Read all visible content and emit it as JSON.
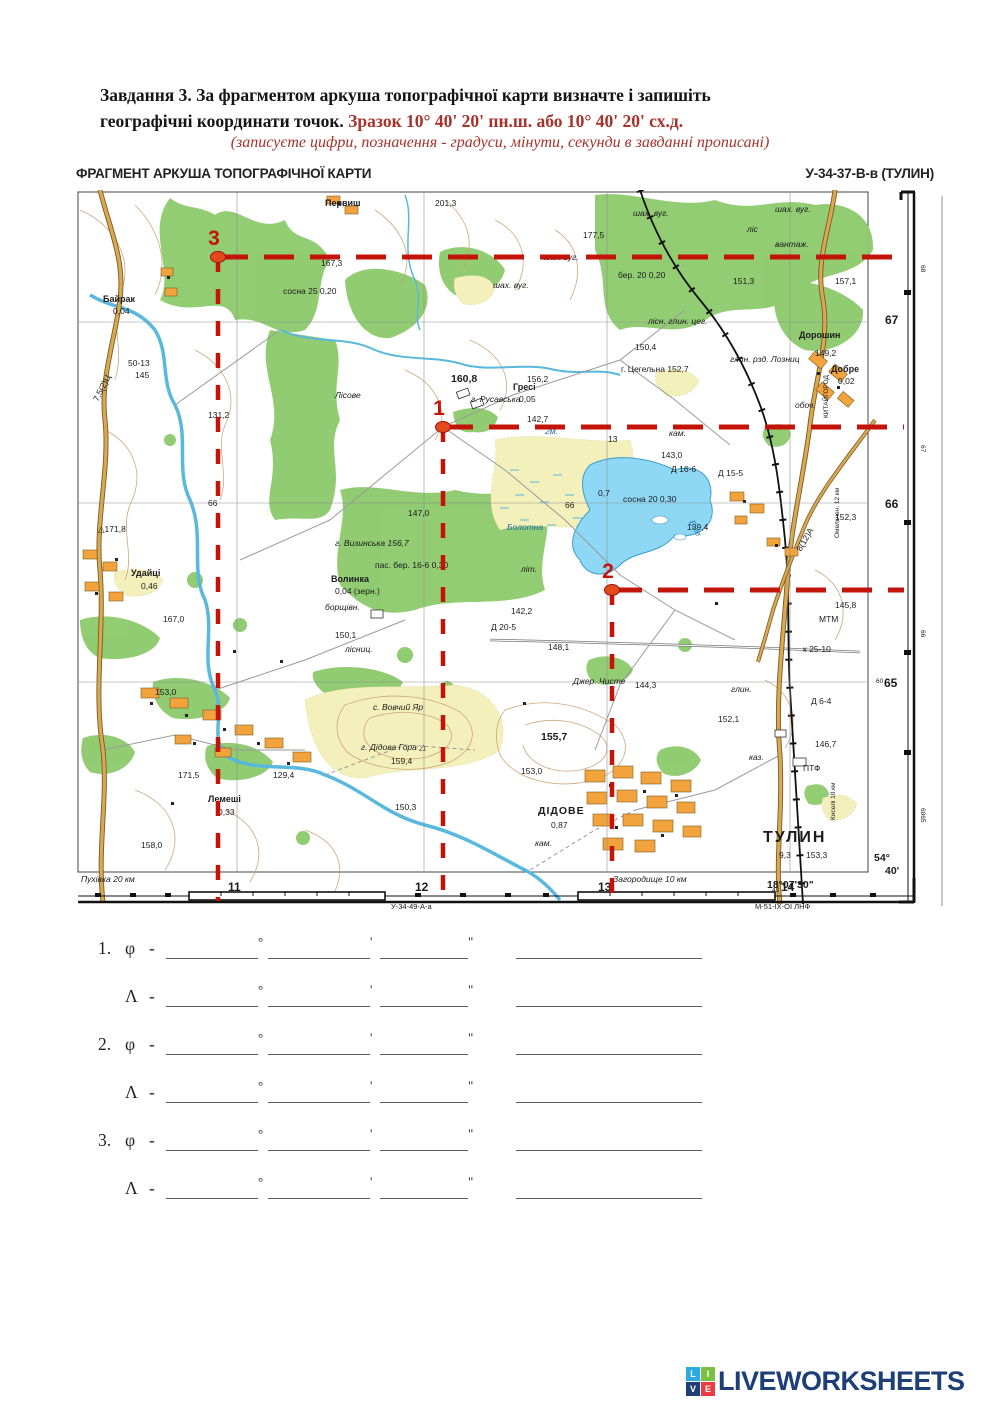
{
  "header": {
    "task_line1": "Завдання 3. За фрагментом аркуша топографічної карти визначте і запишіть",
    "task_line2": "географічні координати точок.",
    "sample": "Зразок 10° 40' 20' пн.ш.  або 10° 40' 20' сх.д.",
    "note": "(записуєте цифри, позначення - градуси, мінути, секунди в завданні прописані)",
    "accent_color": "#a8322a"
  },
  "map": {
    "title_left": "ФРАГМЕНТ АРКУША ТОПОГРАФІЧНОЇ КАРТИ",
    "title_right": "У-34-37-В-в (ТУЛИН)",
    "accent": "#c41309",
    "grid": {
      "v": [
        162,
        349,
        532,
        715
      ],
      "h": [
        132,
        313,
        492
      ]
    },
    "points": [
      {
        "n": "3",
        "x": 143,
        "y": 67
      },
      {
        "n": "1",
        "x": 368,
        "y": 237
      },
      {
        "n": "2",
        "x": 537,
        "y": 400
      }
    ],
    "labels": [
      {
        "x": 360,
        "y": 16,
        "t": "201,3"
      },
      {
        "x": 250,
        "y": 16,
        "t": "Первиш",
        "cls": "vil"
      },
      {
        "x": 508,
        "y": 48,
        "t": "177,5"
      },
      {
        "x": 558,
        "y": 26,
        "t": "шах. вуг.",
        "cls": "it"
      },
      {
        "x": 700,
        "y": 22,
        "t": "шах. вуг.",
        "cls": "it"
      },
      {
        "x": 672,
        "y": 42,
        "t": "ліс",
        "cls": "it"
      },
      {
        "x": 418,
        "y": 98,
        "t": "шах. вуг.",
        "cls": "it"
      },
      {
        "x": 468,
        "y": 70,
        "t": "шах. вуг.",
        "cls": "it"
      },
      {
        "x": 700,
        "y": 57,
        "t": "вантаж.",
        "cls": "it"
      },
      {
        "x": 246,
        "y": 76,
        "t": "167,3"
      },
      {
        "x": 543,
        "y": 88,
        "t": "бер. 20 0,20"
      },
      {
        "x": 658,
        "y": 94,
        "t": "151,3"
      },
      {
        "x": 760,
        "y": 94,
        "t": "157,1"
      },
      {
        "x": 28,
        "y": 112,
        "t": "Байрак",
        "cls": "vil"
      },
      {
        "x": 38,
        "y": 124,
        "t": "0,04"
      },
      {
        "x": 208,
        "y": 104,
        "t": "сосна 25 0,20"
      },
      {
        "x": 260,
        "y": 208,
        "t": "Лісове",
        "cls": "it"
      },
      {
        "x": 573,
        "y": 134,
        "t": "лісн. глин. цег.",
        "cls": "it"
      },
      {
        "x": 560,
        "y": 160,
        "t": "150,4"
      },
      {
        "x": 655,
        "y": 172,
        "t": "глин. рзд. Лозниц",
        "cls": "it"
      },
      {
        "x": 724,
        "y": 148,
        "t": "Дорошин",
        "cls": "vil"
      },
      {
        "x": 740,
        "y": 166,
        "t": "149,2"
      },
      {
        "x": 756,
        "y": 182,
        "t": "Добре",
        "cls": "vil"
      },
      {
        "x": 763,
        "y": 194,
        "t": "0,02"
      },
      {
        "x": 546,
        "y": 182,
        "t": "г. Цегельна 152,7"
      },
      {
        "x": 53,
        "y": 176,
        "t": "50-13"
      },
      {
        "x": 60,
        "y": 188,
        "t": "145"
      },
      {
        "x": 133,
        "y": 228,
        "t": "131,2"
      },
      {
        "x": 548,
        "y": 312,
        "t": "сосна 20 0,30"
      },
      {
        "x": 376,
        "y": 192,
        "t": "160,8",
        "cls": "md2"
      },
      {
        "x": 452,
        "y": 192,
        "t": "156,2"
      },
      {
        "x": 396,
        "y": 212,
        "t": "г. Русавська",
        "cls": "it"
      },
      {
        "x": 438,
        "y": 200,
        "t": "Гресі",
        "cls": "vil"
      },
      {
        "x": 444,
        "y": 212,
        "t": "0,05"
      },
      {
        "x": 452,
        "y": 232,
        "t": "142,7"
      },
      {
        "x": 470,
        "y": 244,
        "t": "2м.",
        "cls": "itb"
      },
      {
        "x": 594,
        "y": 246,
        "t": "кам.",
        "cls": "it"
      },
      {
        "x": 586,
        "y": 268,
        "t": "143,0"
      },
      {
        "x": 596,
        "y": 282,
        "t": "Д 16-6"
      },
      {
        "x": 643,
        "y": 286,
        "t": "Д 15-5"
      },
      {
        "x": 720,
        "y": 218,
        "t": "обоч.",
        "cls": "it"
      },
      {
        "x": 523,
        "y": 306,
        "t": "0,7"
      },
      {
        "x": 533,
        "y": 252,
        "t": "13"
      },
      {
        "x": 490,
        "y": 318,
        "t": "66"
      },
      {
        "x": 133,
        "y": 316,
        "t": "66"
      },
      {
        "x": 612,
        "y": 340,
        "t": "139,4"
      },
      {
        "x": 432,
        "y": 340,
        "t": "Болотна",
        "cls": "itb"
      },
      {
        "x": 614,
        "y": 332,
        "t": "Біле",
        "cls": "itb",
        "r": 62
      },
      {
        "x": 760,
        "y": 330,
        "t": "152,3"
      },
      {
        "x": 23,
        "y": 342,
        "t": "△171,8"
      },
      {
        "x": 56,
        "y": 386,
        "t": "Удайці",
        "cls": "vil"
      },
      {
        "x": 66,
        "y": 399,
        "t": "0,46"
      },
      {
        "x": 333,
        "y": 326,
        "t": "147,0"
      },
      {
        "x": 260,
        "y": 356,
        "t": "г. Визинська 156,7",
        "cls": "it"
      },
      {
        "x": 256,
        "y": 392,
        "t": "Волинка",
        "cls": "vil"
      },
      {
        "x": 260,
        "y": 404,
        "t": "0,04 (зерн.)"
      },
      {
        "x": 250,
        "y": 420,
        "t": "борщівн.",
        "cls": "it"
      },
      {
        "x": 88,
        "y": 432,
        "t": "167,0"
      },
      {
        "x": 260,
        "y": 448,
        "t": "150,1"
      },
      {
        "x": 270,
        "y": 462,
        "t": "лісниц.",
        "cls": "it"
      },
      {
        "x": 300,
        "y": 378,
        "t": "пас. бер. 16-6 0,30"
      },
      {
        "x": 416,
        "y": 440,
        "t": "Д 20-5"
      },
      {
        "x": 436,
        "y": 424,
        "t": "142,2"
      },
      {
        "x": 473,
        "y": 460,
        "t": "148,1"
      },
      {
        "x": 446,
        "y": 382,
        "t": "літ.",
        "cls": "it"
      },
      {
        "x": 498,
        "y": 494,
        "t": "Джер. Чисте",
        "cls": "it"
      },
      {
        "x": 560,
        "y": 498,
        "t": "144,3"
      },
      {
        "x": 656,
        "y": 502,
        "t": "глин.",
        "cls": "it"
      },
      {
        "x": 643,
        "y": 532,
        "t": "152,1"
      },
      {
        "x": 466,
        "y": 550,
        "t": "155,7",
        "cls": "md2"
      },
      {
        "x": 446,
        "y": 584,
        "t": "153,0"
      },
      {
        "x": 80,
        "y": 505,
        "t": "153,0"
      },
      {
        "x": 103,
        "y": 588,
        "t": "171,5"
      },
      {
        "x": 133,
        "y": 612,
        "t": "Лемеші",
        "cls": "vil"
      },
      {
        "x": 143,
        "y": 625,
        "t": "0,33"
      },
      {
        "x": 198,
        "y": 588,
        "t": "129,4"
      },
      {
        "x": 298,
        "y": 520,
        "t": "с. Вовчий Яр",
        "cls": "it"
      },
      {
        "x": 286,
        "y": 560,
        "t": "г. Дідова Гора △",
        "cls": "it"
      },
      {
        "x": 316,
        "y": 574,
        "t": "159,4"
      },
      {
        "x": 320,
        "y": 620,
        "t": "150,3"
      },
      {
        "x": 66,
        "y": 658,
        "t": "158,0"
      },
      {
        "x": 463,
        "y": 624,
        "t": "ДІДОВЕ",
        "cls": "town"
      },
      {
        "x": 476,
        "y": 638,
        "t": "0,87"
      },
      {
        "x": 460,
        "y": 656,
        "t": "кам.",
        "cls": "it"
      },
      {
        "x": 740,
        "y": 557,
        "t": "146,7"
      },
      {
        "x": 674,
        "y": 570,
        "t": "каз.",
        "cls": "it"
      },
      {
        "x": 728,
        "y": 581,
        "t": "ПТФ"
      },
      {
        "x": 744,
        "y": 432,
        "t": "МТМ"
      },
      {
        "x": 760,
        "y": 418,
        "t": "145,8"
      },
      {
        "x": 728,
        "y": 462,
        "t": "к 25-10"
      },
      {
        "x": 736,
        "y": 514,
        "t": "Д 6-4"
      },
      {
        "x": 688,
        "y": 652,
        "t": "ТУЛИН",
        "cls": "city"
      },
      {
        "x": 704,
        "y": 668,
        "t": "9,3"
      },
      {
        "x": 731,
        "y": 668,
        "t": "153,3"
      },
      {
        "x": 23,
        "y": 212,
        "t": "7,5(2)Ц",
        "r": -63
      },
      {
        "x": 726,
        "y": 362,
        "t": "8(12)А",
        "r": -60
      },
      {
        "x": 753,
        "y": 228,
        "t": "КИТАЙГОРОД",
        "r": -90,
        "cls": "tiny"
      },
      {
        "x": 764,
        "y": 348,
        "t": "Омельчен. 12 км",
        "r": -90,
        "cls": "tiny"
      },
      {
        "x": 760,
        "y": 630,
        "t": "Киселі 10 км",
        "r": -90,
        "cls": "tiny"
      },
      {
        "x": 810,
        "y": 134,
        "t": "67",
        "cls": "md"
      },
      {
        "x": 810,
        "y": 318,
        "t": "66",
        "cls": "md"
      },
      {
        "x": 801,
        "y": 493,
        "t": "60",
        "cls": "tiny"
      },
      {
        "x": 809,
        "y": 497,
        "t": "65",
        "cls": "md"
      },
      {
        "x": 799,
        "y": 671,
        "t": "54°",
        "cls": "md2"
      },
      {
        "x": 810,
        "y": 684,
        "t": "40'",
        "cls": "md2"
      },
      {
        "x": 692,
        "y": 698,
        "t": "18°07'30\"",
        "cls": "md2"
      },
      {
        "x": 846,
        "y": 75,
        "t": "68",
        "r": 90,
        "cls": "tiny"
      },
      {
        "x": 846,
        "y": 255,
        "t": "67",
        "r": 90,
        "cls": "tiny"
      },
      {
        "x": 846,
        "y": 440,
        "t": "66",
        "r": 90,
        "cls": "tiny"
      },
      {
        "x": 846,
        "y": 618,
        "t": "6065",
        "r": 90,
        "cls": "tiny"
      },
      {
        "x": 6,
        "y": 692,
        "t": "Пухівка 20 км",
        "cls": "it"
      },
      {
        "x": 538,
        "y": 692,
        "t": "Загородище 10 км",
        "cls": "it"
      },
      {
        "x": 153,
        "y": 701,
        "t": "11",
        "cls": "md"
      },
      {
        "x": 340,
        "y": 701,
        "t": "12",
        "cls": "md"
      },
      {
        "x": 523,
        "y": 701,
        "t": "13",
        "cls": "md"
      },
      {
        "x": 697,
        "y": 702,
        "t": "43",
        "cls": "tiny"
      },
      {
        "x": 706,
        "y": 701,
        "t": "14",
        "cls": "md"
      },
      {
        "x": 316,
        "y": 719,
        "t": "У-34-49-А-а",
        "cls": "tiny2"
      },
      {
        "x": 680,
        "y": 719,
        "t": "М-51-ІХ-ОІ ЛНФ",
        "cls": "tiny2"
      }
    ]
  },
  "answers": {
    "dash": "-",
    "deg": "°",
    "min": "'",
    "sec": "\"",
    "rows": [
      {
        "num": "1.",
        "sym": "φ"
      },
      {
        "num": "",
        "sym": "Λ"
      },
      {
        "num": "2.",
        "sym": "φ"
      },
      {
        "num": "",
        "sym": "Λ"
      },
      {
        "num": "3.",
        "sym": "φ"
      },
      {
        "num": "",
        "sym": "Λ"
      }
    ]
  },
  "logo": {
    "text": "LIVEWORKSHEETS",
    "text_color": "#1e3e78",
    "tiles": [
      {
        "ch": "L",
        "color": "#29abe2"
      },
      {
        "ch": "I",
        "color": "#7ac143"
      },
      {
        "ch": "V",
        "color": "#1e3e78"
      },
      {
        "ch": "E",
        "color": "#ed3b43"
      }
    ]
  }
}
